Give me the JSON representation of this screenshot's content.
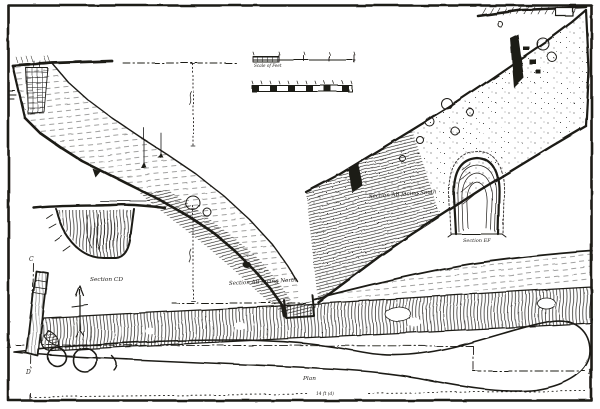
{
  "palette": {
    "ink": "#1c1a17",
    "paper": "#ffffff"
  },
  "figure": {
    "scale_label": "Scale of Feet",
    "sections": {
      "ab_south": "Section AB facing South",
      "ab_north": "Section AB facing North",
      "cd": "Section CD",
      "ef": "Section EF"
    },
    "plan_label": "Plan",
    "points": {
      "a": "A",
      "b": "B",
      "c": "C",
      "d": "D"
    },
    "baseline_note": "14 ft (d)"
  }
}
